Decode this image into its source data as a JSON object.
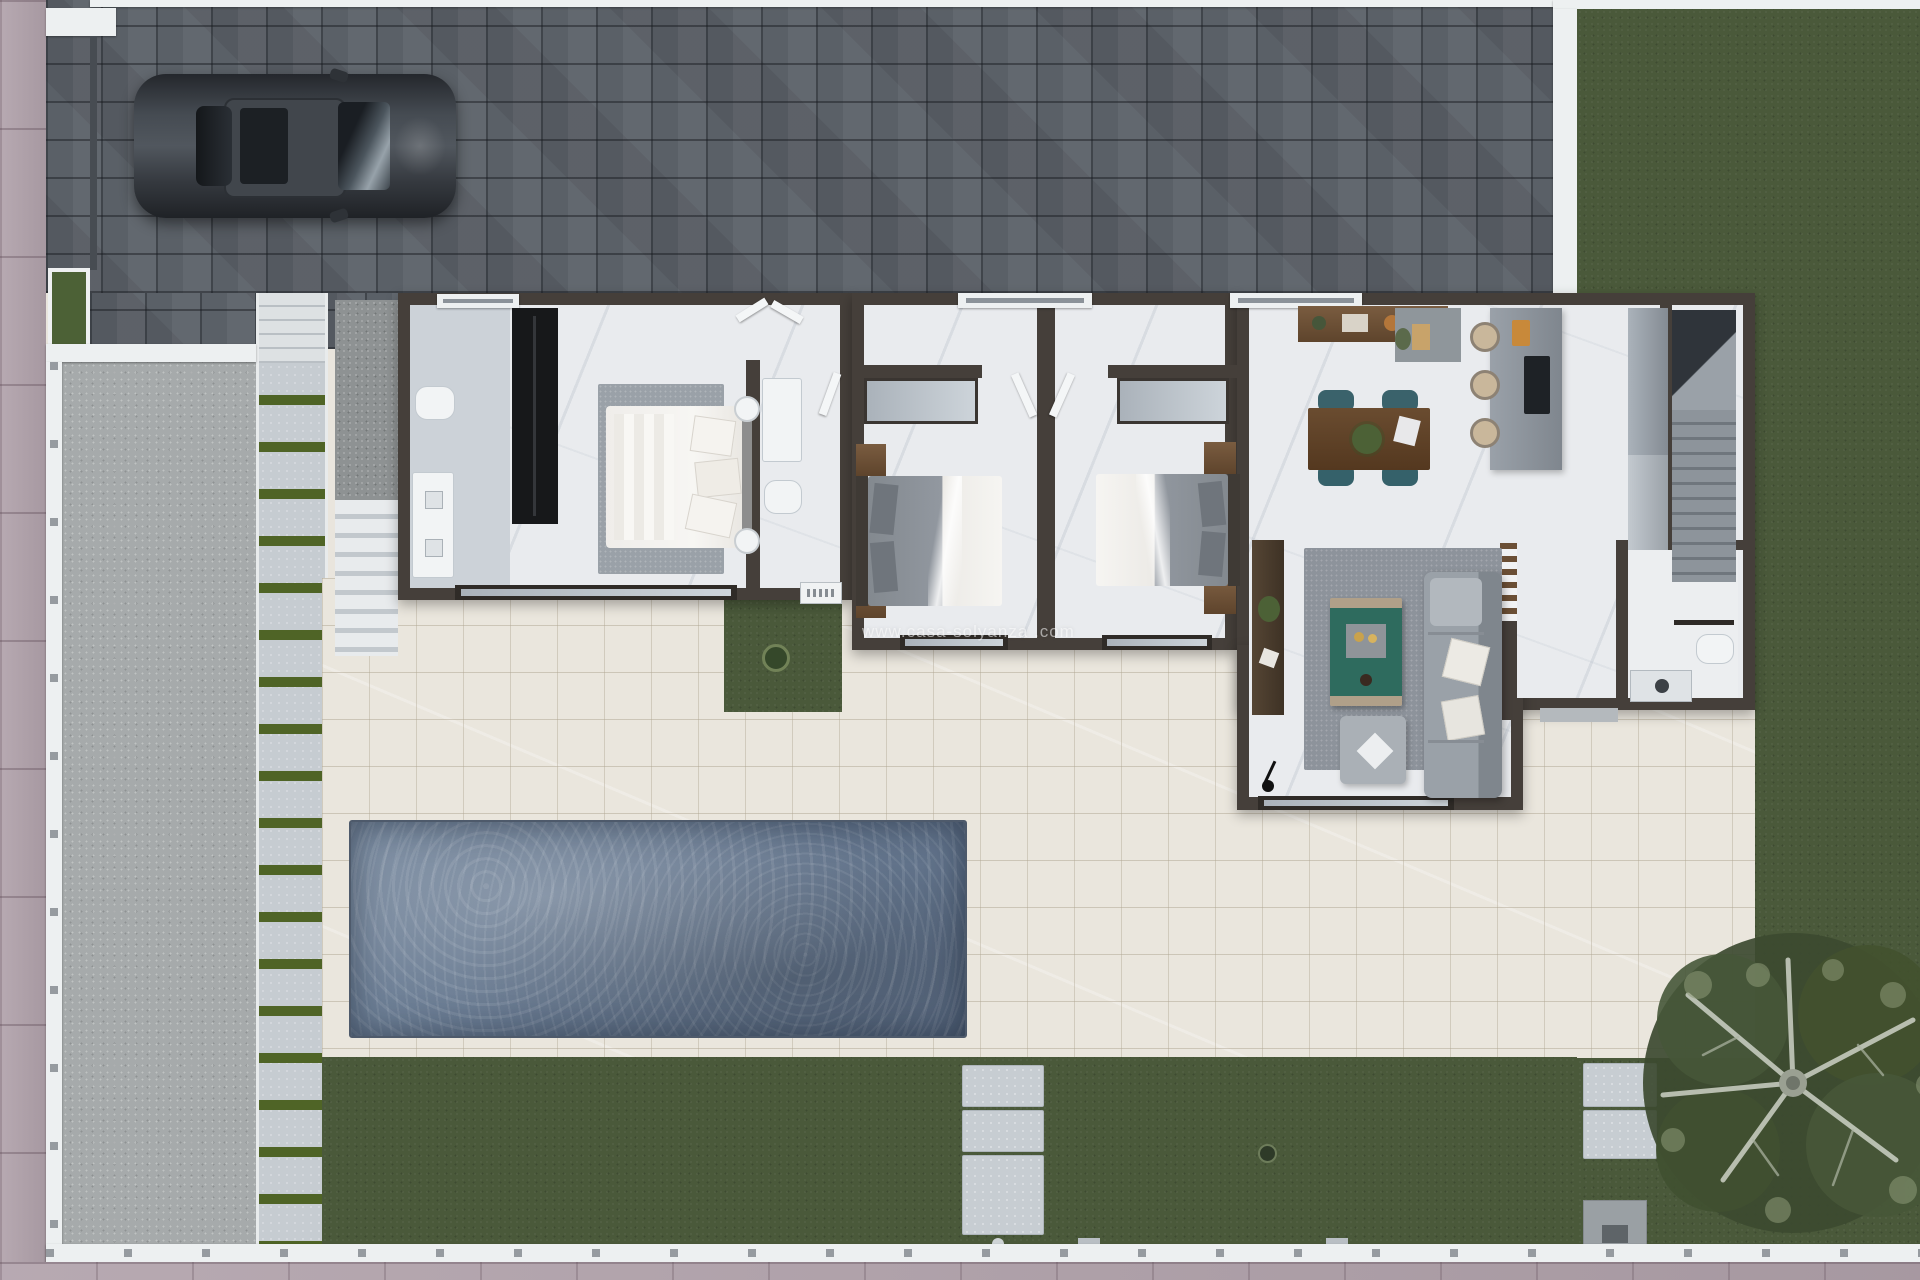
{
  "watermark": {
    "text": "www.casa-solyanza .com",
    "color": "#ffffff",
    "opacity": 0.55
  },
  "scene": {
    "type": "aerial-3d-floor-plan-render",
    "description": "Top-down 3D render of a single-storey villa plot with pool, gardens, paved driveway with parked car, three bedrooms, three bathrooms, open kitchen-living area and stairs",
    "car": "dark grey car parked on grey block-paved driveway",
    "tree": "olive tree on bottom-right lawn"
  },
  "palette": {
    "sidewalk_pink": "#b1a2ab",
    "driveway_paver": "#5a6067",
    "lawn_green": "#4a593a",
    "terrace_cream": "#eae6dd",
    "pool_water": "#66788e",
    "house_wall": "#453f3a",
    "marble_floor": "#e9ebee",
    "gravel_grey": "#a6aaab",
    "walkway_stripe_green": "#4f6426",
    "wood_furniture": "#6d5137",
    "dining_chair_teal": "#3a626b",
    "coffee_table_teal": "#2e6b5e",
    "stool_tan": "#c9b79b",
    "door_mat_tan": "#c8a36a"
  }
}
